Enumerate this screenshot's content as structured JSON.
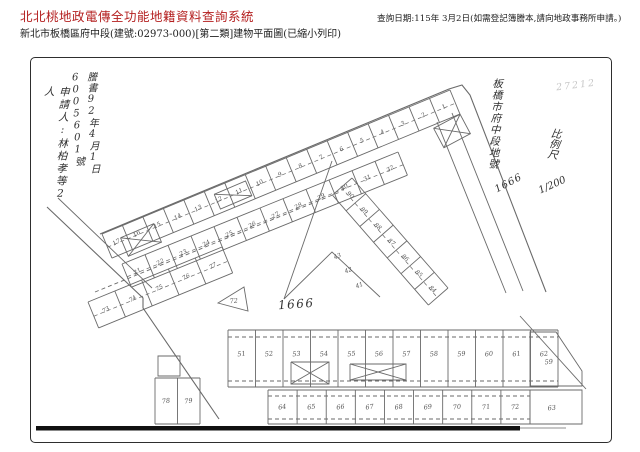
{
  "header": {
    "title": "北北桃地政電傳全功能地籍資料查詢系統",
    "title_color": "#b42020",
    "query_date": "查詢日期:115年 3月2日(如需登記簿謄本,請向地政事務所申請。)",
    "subtitle": "新北市板橋區府中段(建號:02973-000)[第二類]建物平面圖(已縮小列印)"
  },
  "annotations": {
    "applicant": "申請人:林柏孝等2人",
    "issue_note": "謄書92年4月1日6005601號",
    "district": "板橋市府中段地號",
    "lot_no_hand": "1666",
    "scale_label": "比例尺",
    "scale_value": "1/200",
    "faint_scribble": "27212",
    "center_lot": "1666"
  },
  "plan": {
    "line_color": "#6a6a6a",
    "ink_color": "#555555",
    "bar": {
      "x": 36,
      "y": 426,
      "w": 484,
      "h": 4.5,
      "color": "#111111"
    },
    "bands": [
      {
        "name": "upper-band",
        "p1": [
          102,
          234
        ],
        "p2": [
          450,
          90
        ],
        "depth": 26,
        "n": 17,
        "numbers": [
          "17",
          "16",
          "15",
          "14",
          "13",
          "12",
          "11",
          "10",
          "9",
          "8",
          "7",
          "6",
          "5",
          "4",
          "3",
          "2",
          "1"
        ]
      },
      {
        "name": "second-band",
        "p1": [
          122,
          264
        ],
        "p2": [
          398,
          152
        ],
        "depth": 25,
        "n": 12,
        "numbers": [
          "21",
          "22",
          "23",
          "24",
          "25",
          "26",
          "27",
          "28",
          "29",
          "30",
          "31",
          "32"
        ]
      },
      {
        "name": "left-band",
        "p1": [
          88,
          302
        ],
        "p2": [
          222,
          247
        ],
        "depth": 28,
        "n": 5,
        "numbers": [
          "73",
          "74",
          "75",
          "76",
          "77"
        ]
      },
      {
        "name": "wedge-band",
        "p1": [
          352,
          178
        ],
        "p2": [
          448,
          288
        ],
        "depth": 26,
        "n": 7,
        "numbers": [
          "90",
          "89",
          "88",
          "87",
          "86",
          "85",
          "84"
        ]
      },
      {
        "name": "bottom-row-1",
        "p1": [
          228,
          330
        ],
        "p2": [
          558,
          330
        ],
        "depth": 57,
        "n": 12,
        "dash": false,
        "numAt": 0.42,
        "fs": 6.5,
        "numbers": [
          "51",
          "52",
          "53",
          "54",
          "55",
          "56",
          "57",
          "58",
          "59",
          "60",
          "61",
          "62"
        ]
      },
      {
        "name": "bottom-row-2",
        "p1": [
          268,
          390
        ],
        "p2": [
          530,
          390
        ],
        "depth": 34,
        "n": 9,
        "dash": false,
        "fs": 6.5,
        "numbers": [
          "64",
          "65",
          "66",
          "67",
          "68",
          "69",
          "70",
          "71",
          "72"
        ]
      },
      {
        "name": "left-pair",
        "p1": [
          155,
          378
        ],
        "p2": [
          200,
          378
        ],
        "depth": 46,
        "n": 2,
        "dash": false,
        "fs": 6.5,
        "numbers": [
          "78",
          "79"
        ]
      }
    ],
    "cells": [
      {
        "name": "corner-cell-a",
        "pts": [
          [
            530,
            332
          ],
          [
            556,
            332
          ],
          [
            582,
            371
          ],
          [
            582,
            386
          ],
          [
            530,
            386
          ]
        ],
        "num": "59",
        "nx": 549,
        "ny": 364
      },
      {
        "name": "corner-cell-b",
        "pts": [
          [
            530,
            390
          ],
          [
            582,
            390
          ],
          [
            582,
            424
          ],
          [
            530,
            424
          ]
        ],
        "num": "63",
        "nx": 552,
        "ny": 410
      },
      {
        "name": "tri-cell",
        "pts": [
          [
            218,
            303
          ],
          [
            244,
            287
          ],
          [
            248,
            311
          ]
        ],
        "num": "72",
        "nx": 234,
        "ny": 303
      },
      {
        "name": "small-box",
        "pts": [
          [
            158,
            356
          ],
          [
            180,
            356
          ],
          [
            180,
            376
          ],
          [
            158,
            376
          ]
        ]
      }
    ],
    "labels": [
      {
        "t": "43",
        "x": 338,
        "y": 258,
        "r": -22
      },
      {
        "t": "42",
        "x": 349,
        "y": 272,
        "r": -22
      },
      {
        "t": "41",
        "x": 360,
        "y": 287,
        "r": -22
      }
    ],
    "xboxes": [
      {
        "cx": 310,
        "cy": 373,
        "w": 38,
        "h": 22,
        "r": 0
      },
      {
        "cx": 378,
        "cy": 372,
        "w": 56,
        "h": 16,
        "r": 0
      },
      {
        "cx": 141,
        "cy": 240,
        "w": 36,
        "h": 20,
        "r": -23
      },
      {
        "cx": 452,
        "cy": 131,
        "w": 30,
        "h": 22,
        "r": -28
      },
      {
        "cx": 233,
        "cy": 195,
        "w": 34,
        "h": 16,
        "r": -23,
        "single": true
      }
    ],
    "lines": [
      {
        "pts": [
          [
            100,
            234
          ],
          [
            449,
            89
          ],
          [
            462,
            85
          ],
          [
            470,
            95
          ],
          [
            546,
            292
          ]
        ],
        "w": 1.1
      },
      {
        "pts": [
          [
            452,
            113
          ],
          [
            523,
            291
          ]
        ]
      },
      {
        "pts": [
          [
            437,
            122
          ],
          [
            506,
            293
          ]
        ]
      },
      {
        "pts": [
          [
            47,
            207
          ],
          [
            143,
            298
          ],
          [
            143,
            308
          ],
          [
            219,
            419
          ]
        ],
        "w": 1.1
      },
      {
        "pts": [
          [
            58,
            198
          ],
          [
            152,
            288
          ]
        ]
      },
      {
        "pts": [
          [
            332,
            161
          ],
          [
            284,
            299
          ]
        ]
      },
      {
        "pts": [
          [
            284,
            299
          ],
          [
            332,
            252
          ],
          [
            380,
            297
          ]
        ]
      },
      {
        "pts": [
          [
            520,
            316
          ],
          [
            586,
            389
          ]
        ]
      },
      {
        "pts": [
          [
            95,
            292
          ],
          [
            340,
            192
          ]
        ],
        "dash": true
      },
      {
        "pts": [
          [
            228,
            337
          ],
          [
            558,
            337
          ]
        ],
        "dash": true
      },
      {
        "pts": [
          [
            228,
            381
          ],
          [
            558,
            381
          ]
        ],
        "dash": true
      },
      {
        "pts": [
          [
            268,
            396
          ],
          [
            530,
            396
          ]
        ],
        "dash": true
      },
      {
        "pts": [
          [
            268,
            419
          ],
          [
            530,
            419
          ]
        ],
        "dash": true
      },
      {
        "pts": [
          [
            520,
            428
          ],
          [
            566,
            428
          ]
        ],
        "w": 0.8
      }
    ]
  }
}
